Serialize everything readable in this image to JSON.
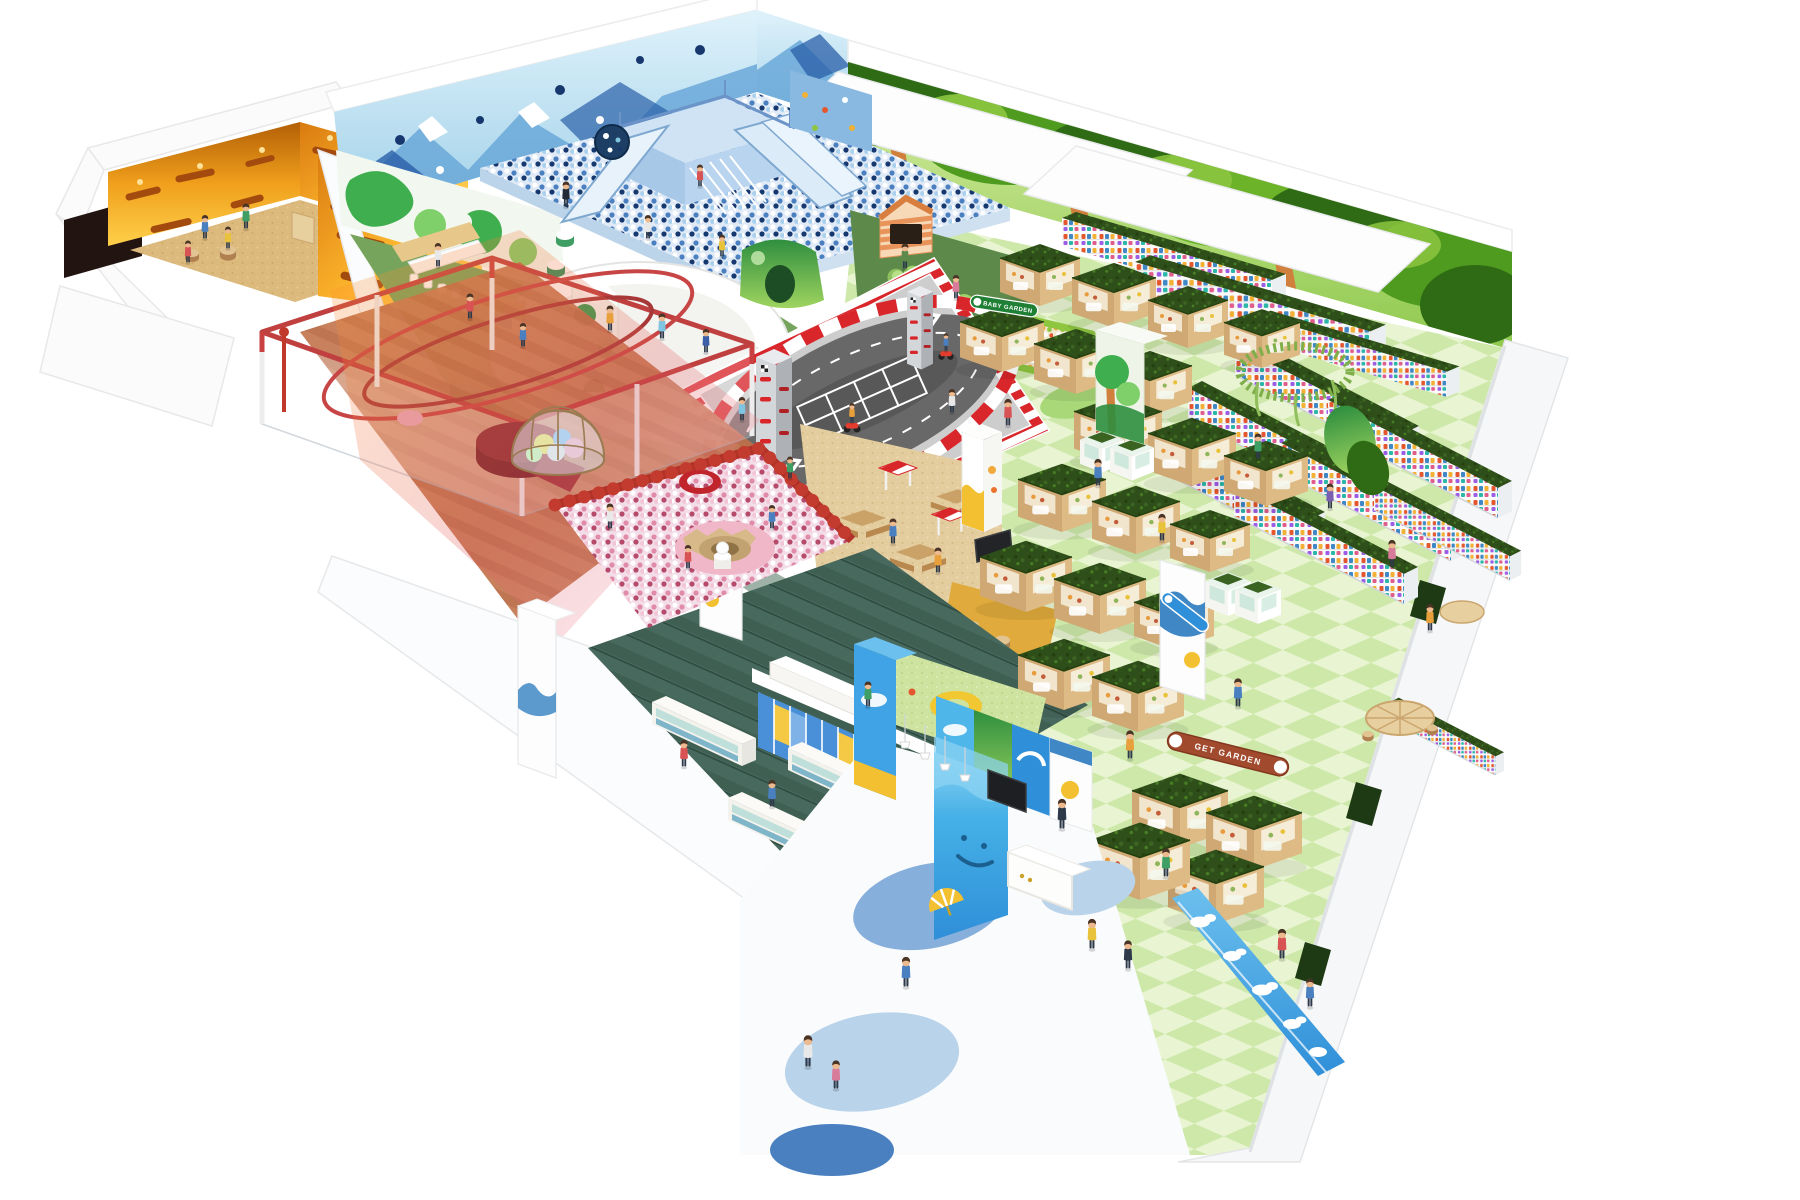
{
  "scene": {
    "type": "isometric-facility-rendering",
    "facility": "indoor kids playground",
    "zones": [
      {
        "id": "sensory-room",
        "label": "orange sensory room",
        "accent": "#f29a1a"
      },
      {
        "id": "rope-course",
        "label": "red rope course enclosure",
        "accent": "#c84040"
      },
      {
        "id": "mountain-ball-pit",
        "label": "blue mountain ball pit with slides",
        "accent": "#9fc3e8"
      },
      {
        "id": "trampoline-lawn",
        "label": "turf lawn with trampoline",
        "accent": "#76a45c"
      },
      {
        "id": "forest-rest-area",
        "label": "forest rest area",
        "accent": "#5d8a4a"
      },
      {
        "id": "baby-garden",
        "label": "baby garden ball pool",
        "accent": "#1e7f35"
      },
      {
        "id": "kart-track",
        "label": "kids kart track",
        "accent": "#d8262b"
      },
      {
        "id": "pink-ball-pit",
        "label": "pink crater ball pit",
        "accent": "#e08ba8"
      },
      {
        "id": "balloon-dome",
        "label": "balloon dome",
        "accent": "#d9c08f"
      },
      {
        "id": "picnic-area",
        "label": "picnic snack area",
        "accent": "#d9bc84"
      },
      {
        "id": "garden-market",
        "label": "garden market stalls",
        "accent": "#c89f68"
      },
      {
        "id": "gacha-lanes",
        "label": "capsule machine lanes",
        "accent": "#31511c"
      },
      {
        "id": "shoe-lockers",
        "label": "shoe locker area",
        "accent": "#4f7264"
      },
      {
        "id": "reception",
        "label": "reception entrance",
        "accent": "#45b0e6"
      }
    ]
  },
  "signs": {
    "baby_garden": "BABY GARDEN",
    "get_garden": "GET GARDEN"
  },
  "palette": {
    "wall_white": "#f7f8f9",
    "turf_green": "#76a45c",
    "checker_light": "#e9f5d2",
    "checker_dark": "#cde8a9",
    "track_asphalt": "#636363",
    "curb_red": "#d8262b",
    "hedge_green": "#30511b",
    "wood": "#c89f68",
    "sky_blue": "#45b0e6",
    "ball_blue": "#4a7fc0",
    "ball_pink": "#e08ba8",
    "orange_wall": "#f0a01c"
  }
}
